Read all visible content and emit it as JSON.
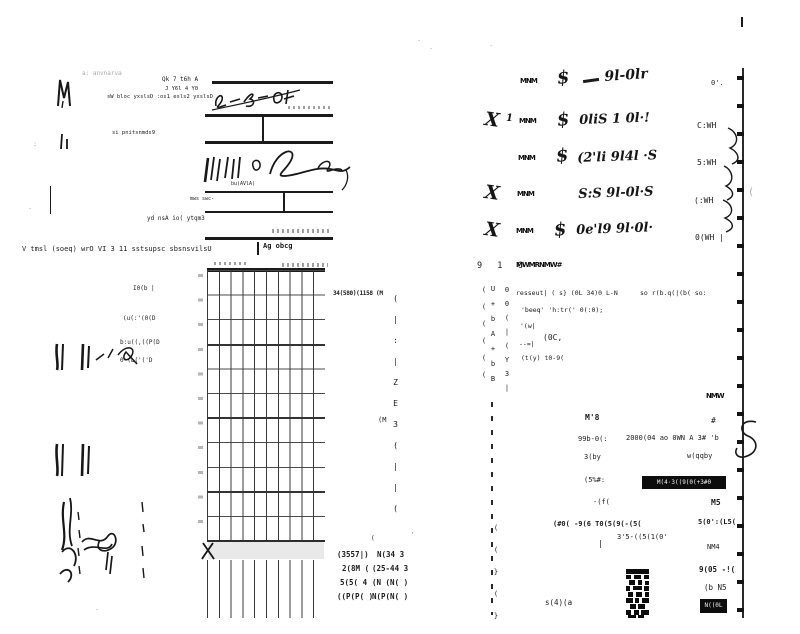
{
  "doc": {
    "bg": "#ffffff",
    "ink": "#1b1b1b",
    "faint": "#a8a8a8"
  },
  "stub": {
    "faint_note": "a: anvnarva",
    "line1": "Qk 7 t6h A",
    "line2": "J Y6l 4 Y0",
    "dealer_line": "sW bloc yxslsD   :os1 esls2 yxslsD",
    "preliminary": "si pnitsnmds9",
    "trade": "mws swc-",
    "empty": "yd    nsA io( ytqm3",
    "by_date": "Ag   obcg",
    "sig_tag": "bu(AVlA)",
    "bottom_line": "V tmsl (soeq) wrO VI 3 11 sstsupsc sbsnsvilsU"
  },
  "grid": {
    "side_header": "34(580)(1158 (M",
    "side_col": "(|:|ZE3(||(",
    "side_m": "(M"
  },
  "codes": {
    "tick": "(",
    "tick2": "'",
    "rows": [
      {
        "a": "(3557|)",
        "b": "N(34 3"
      },
      {
        "a": "2(8M (",
        "b": "(25-44 3"
      },
      {
        "a": "5(5( 4",
        "b": "(N (N( )"
      },
      {
        "a": "((P(P( )",
        "b": "N(P(N( )"
      }
    ]
  },
  "margin": {
    "l1": "I0(b |",
    "l2": "(u(:'(0(D",
    "l3": "b:u((,((P(D",
    "l4": "0-(L('('D",
    "colon": ":",
    "dot": "·"
  },
  "rtop": {
    "rows": [
      {
        "check": "",
        "num": "",
        "tag": "MNM",
        "dollar": "$",
        "amount": "9l-0lr"
      },
      {
        "check": "X",
        "num": "1",
        "tag": "MNM",
        "dollar": "$",
        "amount": "0liS 1 0l·!"
      },
      {
        "check": "",
        "num": "",
        "tag": "MNM",
        "dollar": "$",
        "amount": "(2'li 9l4l ·S"
      },
      {
        "check": "X",
        "num": "",
        "tag": "MNM",
        "dollar": "",
        "amount": "S:S  9l-0l·S"
      },
      {
        "check": "X",
        "num": "",
        "tag": "MNM",
        "dollar": "$",
        "amount": "0e'l9  9l·0l·"
      }
    ],
    "footer_chars": "9 1 C",
    "footer_tag": "MWMRNMW#"
  },
  "redge": {
    "labels": [
      "0'.",
      "C:WH",
      "5:WH",
      "(:WH",
      "0(WH |"
    ],
    "curl": "("
  },
  "rblock": {
    "vc1": "((((((",
    "vc2": "U+bA+bB",
    "vc3": "00(|(Y3|",
    "vc4": "((}(}",
    "row1": "resseut| ( s}   (0L   34)0 L-N",
    "row2": "'beeq' 'h:tr('  0(:0);",
    "row3": "'(w|",
    "row4": "(0C,",
    "row5": "--=|",
    "row6": "(t(y)   t0-9(",
    "row_right": "so r(b.q(|(b( so:"
  },
  "rfields": {
    "f_tag": "NMW",
    "f_plus": "#",
    "f_m8": "M'8",
    "f_99b": "99b-0(:",
    "f_2000": "2000(04 ao 0WN A 3# 'b",
    "f_3by": "3(by",
    "f_wqq": "w(qqby",
    "f_5pct": "(5%#:",
    "banner": "M(4·3((9(0(+3#0",
    "f_ufl": "-(f(",
    "f_m5": "M5",
    "f_long": "(#0( -9(6 T0(5(9(-(5(",
    "f_50": "5(0':(L5(",
    "f_35": "3'5-((5(1(0'",
    "f_bar": "|",
    "f_nm4": "NM4",
    "f_905": "9(05 -!(",
    "f_b5": "(b N5",
    "f_s4a": "s(4)(a",
    "f_blob": "N((0L"
  },
  "specks": {
    "d1": "·",
    "d2": "·",
    "d3": "·"
  }
}
